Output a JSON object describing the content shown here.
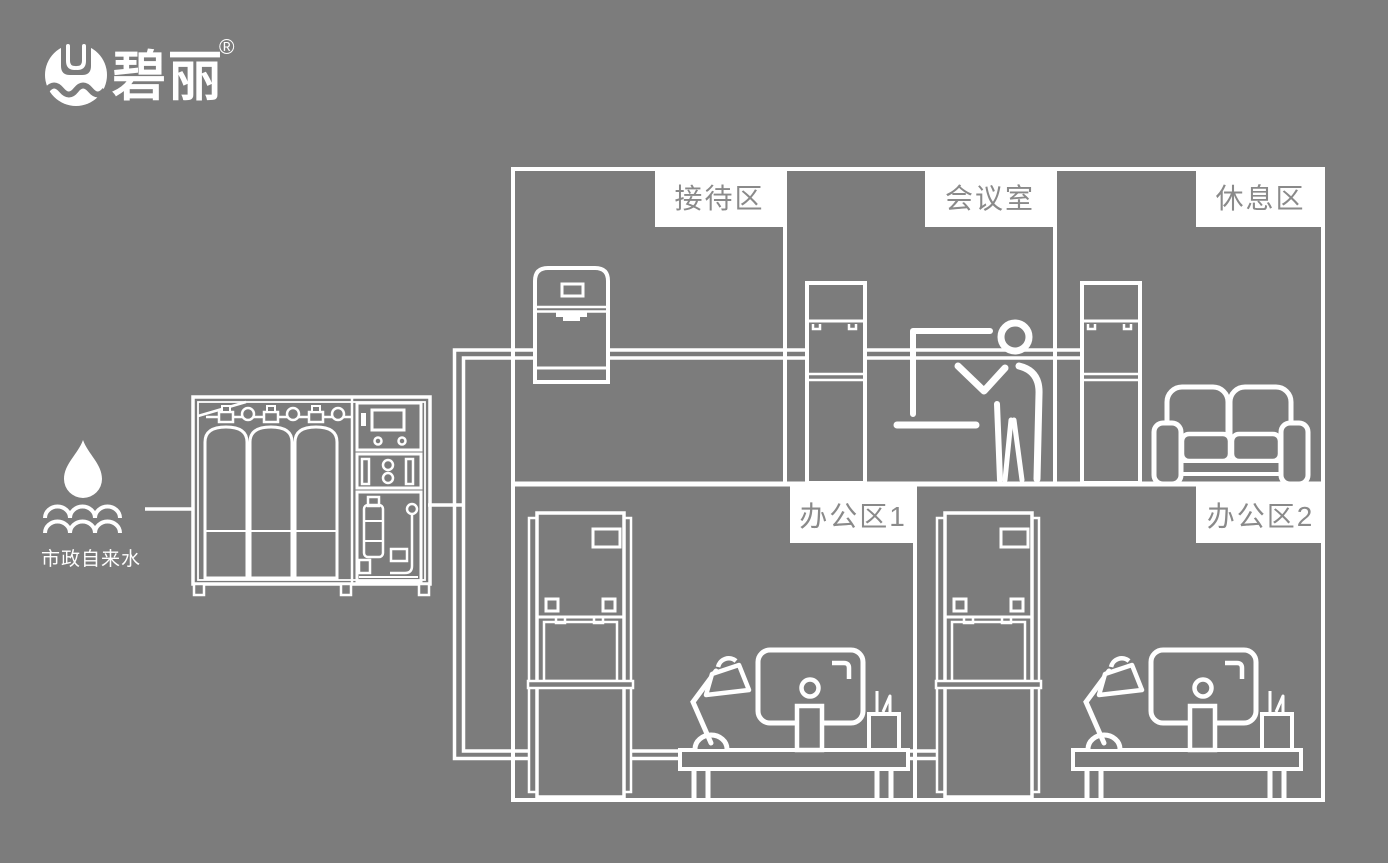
{
  "colors": {
    "background": "#7c7c7c",
    "line": "#ffffff",
    "label_background": "#ffffff",
    "label_text": "#8a8a8a"
  },
  "brand": {
    "name": "碧丽",
    "registered_mark": "®",
    "logo_icon": "water-cup-logo-icon"
  },
  "water_source": {
    "label": "市政自来水",
    "icon": "water-drop-icon"
  },
  "floor_plan": {
    "rooms": [
      {
        "id": "reception",
        "label": "接待区"
      },
      {
        "id": "meeting-room",
        "label": "会议室"
      },
      {
        "id": "lounge",
        "label": "休息区"
      },
      {
        "id": "office-1",
        "label": "办公区1"
      },
      {
        "id": "office-2",
        "label": "办公区2"
      }
    ]
  },
  "equipment": {
    "central_purifier": "central-water-purification-system",
    "devices": [
      "countertop-dispenser",
      "upright-dispenser-meeting",
      "upright-dispenser-lounge",
      "floor-standing-dispenser-office1",
      "floor-standing-dispenser-office2"
    ]
  }
}
